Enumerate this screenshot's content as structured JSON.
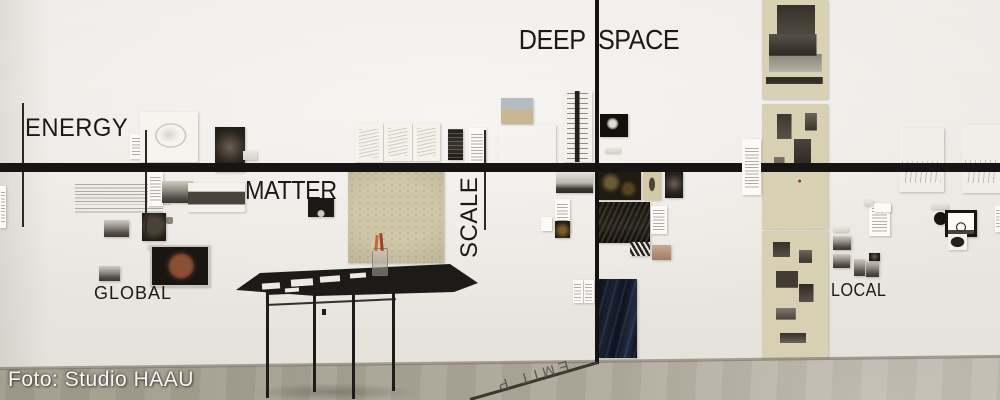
{
  "photo_credit": "Foto: Studio HAAU",
  "axis_labels": {
    "energy": "ENERGY",
    "matter": "MATTER",
    "scale": "SCALE",
    "deep_space": "DEEP SPACE",
    "deep_time_floor": "P TIME",
    "global": "GLOBAL",
    "local": "LOCAL"
  },
  "colors": {
    "wall": "#eae7e1",
    "floor_left": "#a19b8d",
    "floor_right": "#bab4a7",
    "axis_line": "#161514",
    "beige_paper": "#d8d0b2",
    "navy_poster": "#131a28",
    "credit_text": "#f8f7f3"
  },
  "artworks": [
    {
      "x": 130,
      "y": 134,
      "w": 13,
      "h": 25,
      "cls": "text-block-sm"
    },
    {
      "x": 140,
      "y": 112,
      "w": 58,
      "h": 50,
      "cls": "sketch-circle"
    },
    {
      "x": 215,
      "y": 127,
      "w": 30,
      "h": 45,
      "cls": "photo-dark"
    },
    {
      "x": 243,
      "y": 151,
      "w": 14,
      "h": 9,
      "cls": "label-gray"
    },
    {
      "x": 0,
      "y": 186,
      "w": 6,
      "h": 42,
      "cls": "text-block-sm"
    },
    {
      "x": 75,
      "y": 184,
      "w": 96,
      "h": 21,
      "cls": "wall-text"
    },
    {
      "x": 75,
      "y": 208,
      "w": 88,
      "h": 7,
      "cls": "wall-text"
    },
    {
      "x": 166,
      "y": 217,
      "w": 7,
      "h": 7,
      "cls": "tiny-glyph"
    },
    {
      "x": 104,
      "y": 220,
      "w": 25,
      "h": 17,
      "cls": "photo-gray"
    },
    {
      "x": 148,
      "y": 172,
      "w": 15,
      "h": 34,
      "cls": "text-block-sm"
    },
    {
      "x": 162,
      "y": 181,
      "w": 31,
      "h": 22,
      "cls": "photo-gray"
    },
    {
      "x": 188,
      "y": 183,
      "w": 57,
      "h": 29,
      "cls": "etching"
    },
    {
      "x": 142,
      "y": 213,
      "w": 24,
      "h": 28,
      "cls": "photo-dark-round"
    },
    {
      "x": 147,
      "y": 243,
      "w": 14,
      "h": 6,
      "cls": "label-gray"
    },
    {
      "x": 308,
      "y": 198,
      "w": 26,
      "h": 19,
      "cls": "photo-dark-arch"
    },
    {
      "x": 150,
      "y": 245,
      "w": 56,
      "h": 38,
      "cls": "photo-brown-circle"
    },
    {
      "x": 99,
      "y": 266,
      "w": 21,
      "h": 15,
      "cls": "photo-gray"
    },
    {
      "x": 355,
      "y": 123,
      "w": 28,
      "h": 39,
      "cls": "sketch-light"
    },
    {
      "x": 384,
      "y": 123,
      "w": 28,
      "h": 38,
      "cls": "sketch-light"
    },
    {
      "x": 413,
      "y": 123,
      "w": 27,
      "h": 38,
      "cls": "sketch-light"
    },
    {
      "x": 448,
      "y": 129,
      "w": 15,
      "h": 31,
      "cls": "photo-dark-speck"
    },
    {
      "x": 469,
      "y": 128,
      "w": 17,
      "h": 39,
      "cls": "text-block"
    },
    {
      "x": 348,
      "y": 170,
      "w": 96,
      "h": 93,
      "cls": "beige-drawing"
    },
    {
      "x": 501,
      "y": 98,
      "w": 32,
      "h": 26,
      "cls": "photo-sand"
    },
    {
      "x": 499,
      "y": 125,
      "w": 57,
      "h": 38,
      "cls": "photo-mountain"
    },
    {
      "x": 563,
      "y": 91,
      "w": 29,
      "h": 71,
      "cls": "strip-technical"
    },
    {
      "x": 600,
      "y": 114,
      "w": 28,
      "h": 23,
      "cls": "photo-moon"
    },
    {
      "x": 605,
      "y": 148,
      "w": 15,
      "h": 5,
      "cls": "label-gray"
    },
    {
      "x": 556,
      "y": 171,
      "w": 37,
      "h": 22,
      "cls": "photo-pano"
    },
    {
      "x": 555,
      "y": 199,
      "w": 15,
      "h": 34,
      "cls": "text-block"
    },
    {
      "x": 541,
      "y": 217,
      "w": 11,
      "h": 14,
      "cls": "paper-white"
    },
    {
      "x": 555,
      "y": 221,
      "w": 15,
      "h": 17,
      "cls": "photo-dark-gold"
    },
    {
      "x": 573,
      "y": 280,
      "w": 10,
      "h": 23,
      "cls": "text-block-sm"
    },
    {
      "x": 584,
      "y": 280,
      "w": 10,
      "h": 23,
      "cls": "text-block-sm"
    },
    {
      "x": 598,
      "y": 279,
      "w": 39,
      "h": 79,
      "cls": "poster-navy"
    },
    {
      "x": 742,
      "y": 139,
      "w": 19,
      "h": 56,
      "cls": "text-block",
      "z": 8
    },
    {
      "x": 599,
      "y": 171,
      "w": 42,
      "h": 29,
      "cls": "photo-darkpaint"
    },
    {
      "x": 643,
      "y": 172,
      "w": 18,
      "h": 28,
      "cls": "beige-fig"
    },
    {
      "x": 665,
      "y": 172,
      "w": 18,
      "h": 26,
      "cls": "photo-dark"
    },
    {
      "x": 597,
      "y": 202,
      "w": 53,
      "h": 41,
      "cls": "photo-dark-texture"
    },
    {
      "x": 651,
      "y": 206,
      "w": 16,
      "h": 28,
      "cls": "text-block"
    },
    {
      "x": 630,
      "y": 242,
      "w": 20,
      "h": 14,
      "cls": "photo-streaks"
    },
    {
      "x": 652,
      "y": 245,
      "w": 19,
      "h": 15,
      "cls": "photo-sepia"
    },
    {
      "x": 762,
      "y": 0,
      "w": 66,
      "h": 99,
      "cls": "beige-collage-1"
    },
    {
      "x": 762,
      "y": 104,
      "w": 66,
      "h": 125,
      "cls": "beige-collage-2"
    },
    {
      "x": 762,
      "y": 231,
      "w": 66,
      "h": 129,
      "cls": "beige-collage-3"
    },
    {
      "x": 750,
      "y": 139,
      "w": 9,
      "h": 22,
      "cls": "paper-white"
    },
    {
      "x": 869,
      "y": 203,
      "w": 21,
      "h": 33,
      "cls": "text-block"
    },
    {
      "x": 899,
      "y": 128,
      "w": 45,
      "h": 64,
      "cls": "sketch-land"
    },
    {
      "x": 962,
      "y": 125,
      "w": 38,
      "h": 68,
      "cls": "sketch-land"
    },
    {
      "x": 864,
      "y": 200,
      "w": 9,
      "h": 6,
      "cls": "label-gray"
    },
    {
      "x": 874,
      "y": 204,
      "w": 17,
      "h": 8,
      "cls": "paper-white"
    },
    {
      "x": 833,
      "y": 227,
      "w": 15,
      "h": 5,
      "cls": "label-gray"
    },
    {
      "x": 833,
      "y": 236,
      "w": 18,
      "h": 14,
      "cls": "photo-gray"
    },
    {
      "x": 833,
      "y": 254,
      "w": 17,
      "h": 14,
      "cls": "photo-gray"
    },
    {
      "x": 854,
      "y": 259,
      "w": 11,
      "h": 17,
      "cls": "photo-gray"
    },
    {
      "x": 866,
      "y": 261,
      "w": 13,
      "h": 16,
      "cls": "photo-gray"
    },
    {
      "x": 934,
      "y": 212,
      "w": 13,
      "h": 13,
      "cls": "black-dot"
    },
    {
      "x": 931,
      "y": 204,
      "w": 17,
      "h": 5,
      "cls": "label-gray"
    },
    {
      "x": 945,
      "y": 210,
      "w": 26,
      "h": 21,
      "cls": "frame-dome"
    },
    {
      "x": 948,
      "y": 234,
      "w": 19,
      "h": 16,
      "cls": "photo-dark-glyph"
    },
    {
      "x": 869,
      "y": 253,
      "w": 11,
      "h": 8,
      "cls": "photo-dark"
    },
    {
      "x": 995,
      "y": 206,
      "w": 5,
      "h": 26,
      "cls": "text-block-sm"
    },
    {
      "x": 262,
      "y": 283,
      "w": 18,
      "h": 6,
      "cls": "table-paper",
      "z": 13
    },
    {
      "x": 291,
      "y": 279,
      "w": 22,
      "h": 7,
      "cls": "table-paper",
      "z": 13
    },
    {
      "x": 320,
      "y": 276,
      "w": 20,
      "h": 6,
      "cls": "table-paper",
      "z": 13
    },
    {
      "x": 350,
      "y": 273,
      "w": 16,
      "h": 5,
      "cls": "table-paper",
      "z": 13
    },
    {
      "x": 285,
      "y": 288,
      "w": 14,
      "h": 4,
      "cls": "table-paper",
      "z": 13
    }
  ]
}
